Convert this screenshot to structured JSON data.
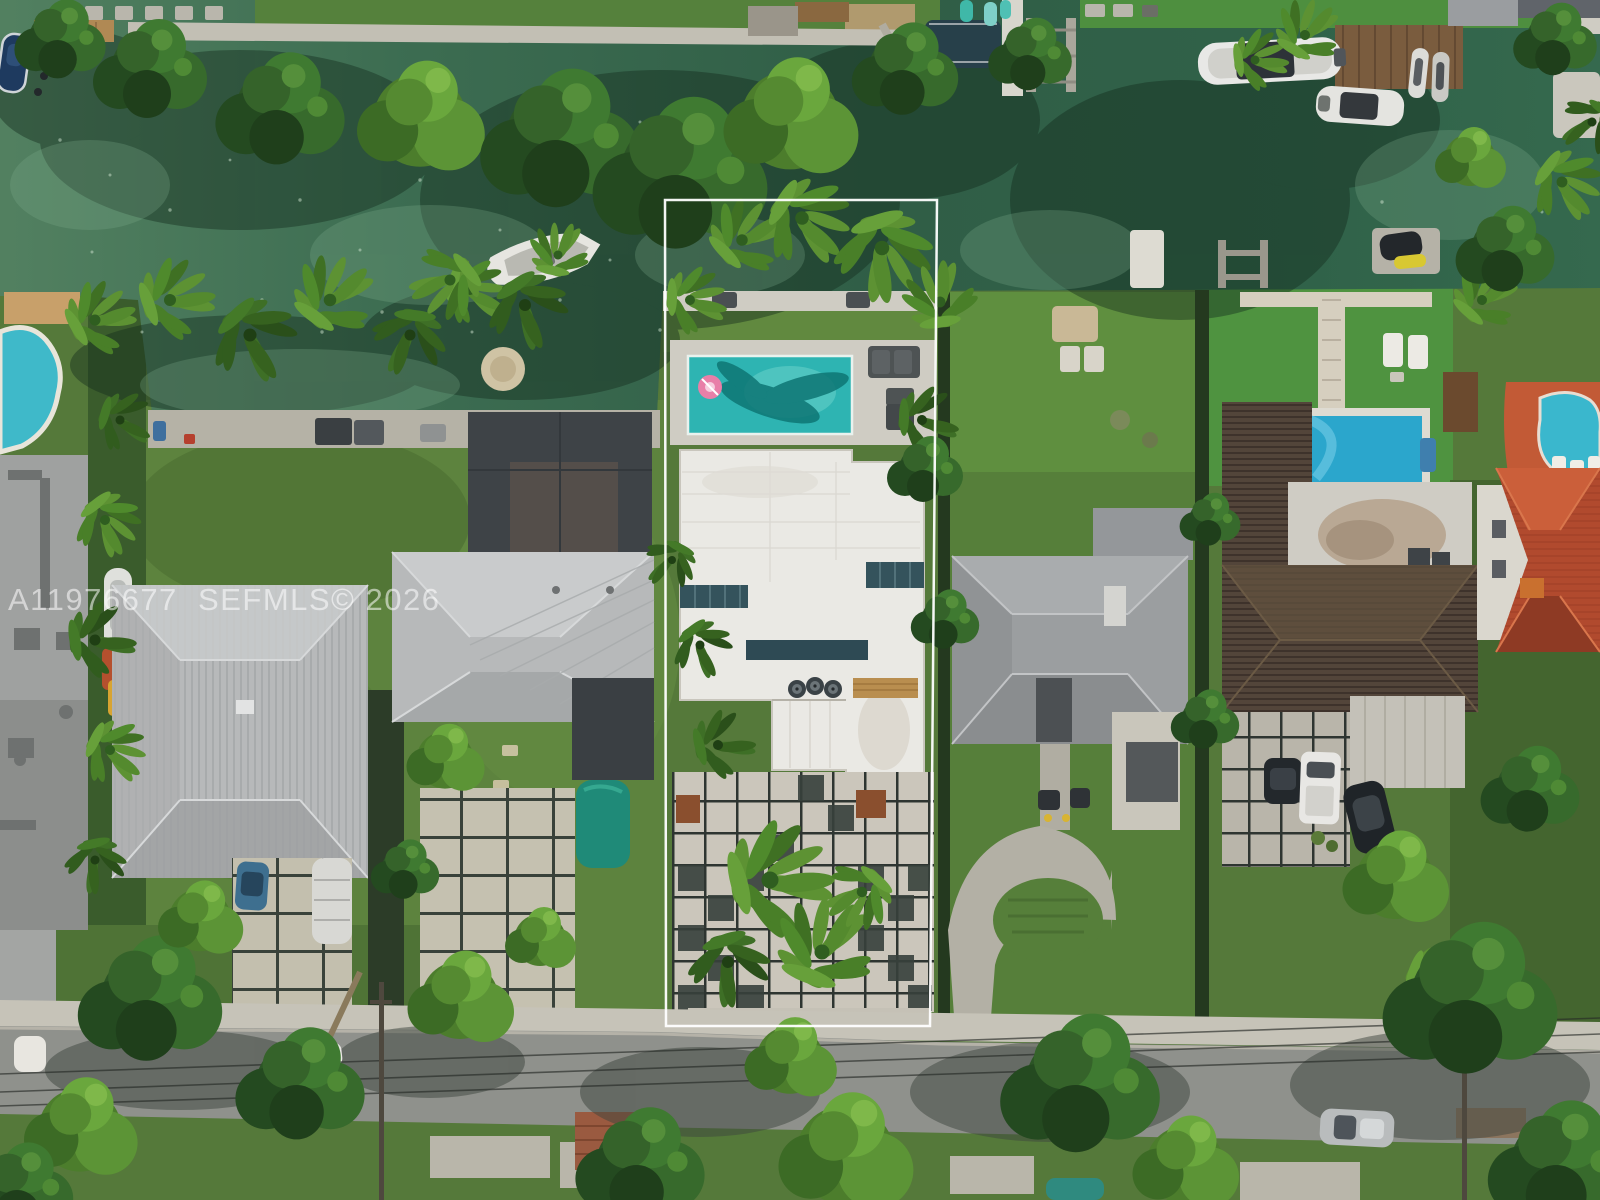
{
  "watermark": {
    "text": "A11976677  SEFMLS© 2026"
  },
  "colors": {
    "canal_water": "#35634a",
    "lawn_base": "#55793a",
    "turf_bright": "#4f9340",
    "road_asphalt": "#8f918c",
    "concrete_deck": "#cfccc3",
    "pool_center_teal": "#2eb4b2",
    "pool_left_teal": "#3fb9c9",
    "pool_right_blue": "#2ba6cc",
    "pool_far_right": "#3ab7cd",
    "pool_float_pink": "#e87fa8",
    "roof_white": "#eae9e4",
    "roof_light_gray": "#b7b9ba",
    "roof_dark_gray": "#3e4347",
    "roof_brown": "#53453a",
    "roof_red_tile": "#b14a2e",
    "property_outline": "#ffffff",
    "watermark_fill": "#ffffff"
  }
}
